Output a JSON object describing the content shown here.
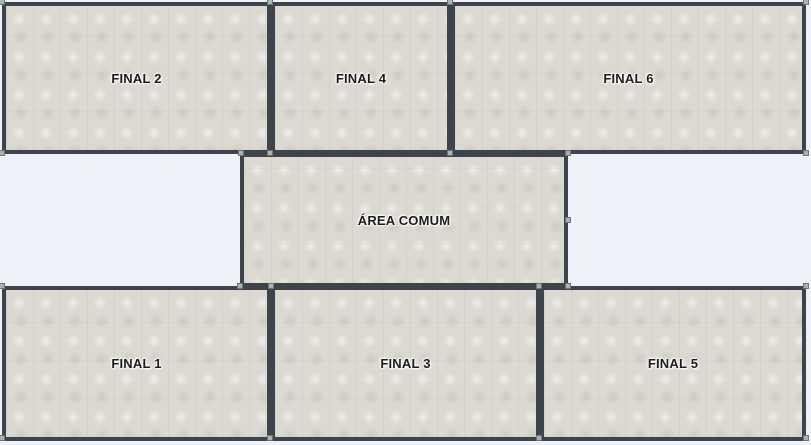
{
  "diagram": {
    "type": "floor-plan-layout",
    "rooms": [
      {
        "label": "FINAL 2"
      },
      {
        "label": "FINAL 4"
      },
      {
        "label": "FINAL 6"
      },
      {
        "label": "ÁREA COMUM"
      },
      {
        "label": "FINAL 1"
      },
      {
        "label": "FINAL 3"
      },
      {
        "label": "FINAL 5"
      }
    ],
    "colors": {
      "page_background": "#eef1f7",
      "room_fill": "#dcd9d2",
      "room_border": "#3e444c",
      "label_text": "#1c1c1c",
      "label_halo": "#ffffff",
      "selection_handle_fill": "#aeb1b4",
      "selection_handle_border": "#6f7478"
    }
  }
}
